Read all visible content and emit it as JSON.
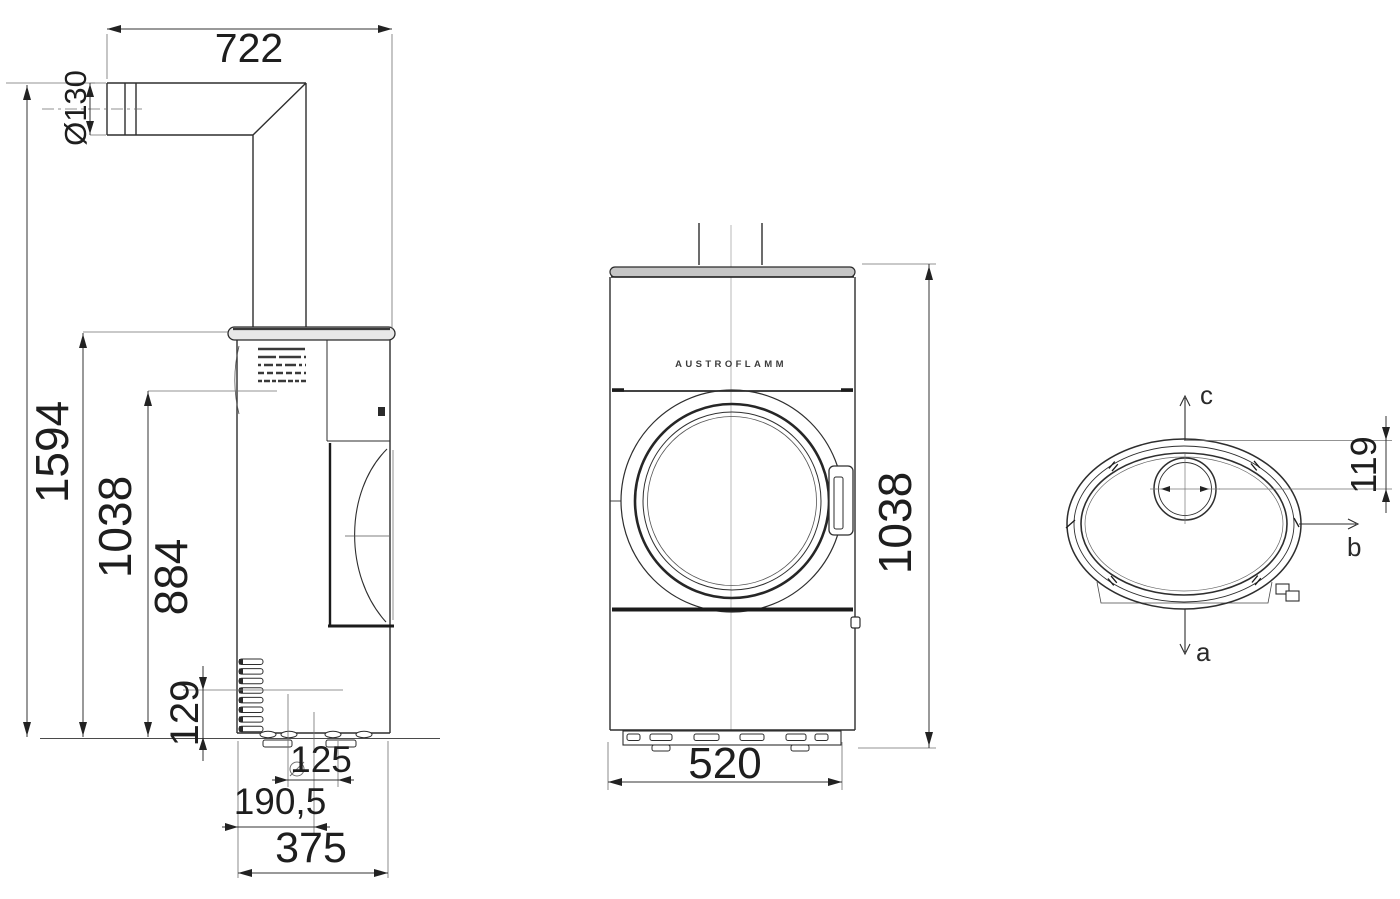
{
  "drawing": {
    "brand": "AUSTROFLAMM",
    "description": "Stove dimensional drawing, three orthographic views"
  },
  "views": {
    "side": {
      "dims": {
        "depth_total": "722",
        "flue_diameter": "Ø130",
        "height_total": "1594",
        "height_body": "1038",
        "height_mid": "884",
        "height_lower": "129",
        "offset_rear": "125",
        "offset_centre": "190,5",
        "depth_body": "375"
      }
    },
    "front": {
      "brand": "AUSTROFLAMM",
      "dims": {
        "height_body": "1038",
        "width_body": "520"
      }
    },
    "top": {
      "dims": {
        "flue_offset": "119"
      },
      "axes": {
        "down": "a",
        "right": "b",
        "up": "c"
      }
    }
  },
  "colors": {
    "line_main": "#2e2e2e",
    "line_heavy": "#1b1b1b",
    "line_thin": "#6f6f6f",
    "plate_fill": "#c6c6c6"
  }
}
